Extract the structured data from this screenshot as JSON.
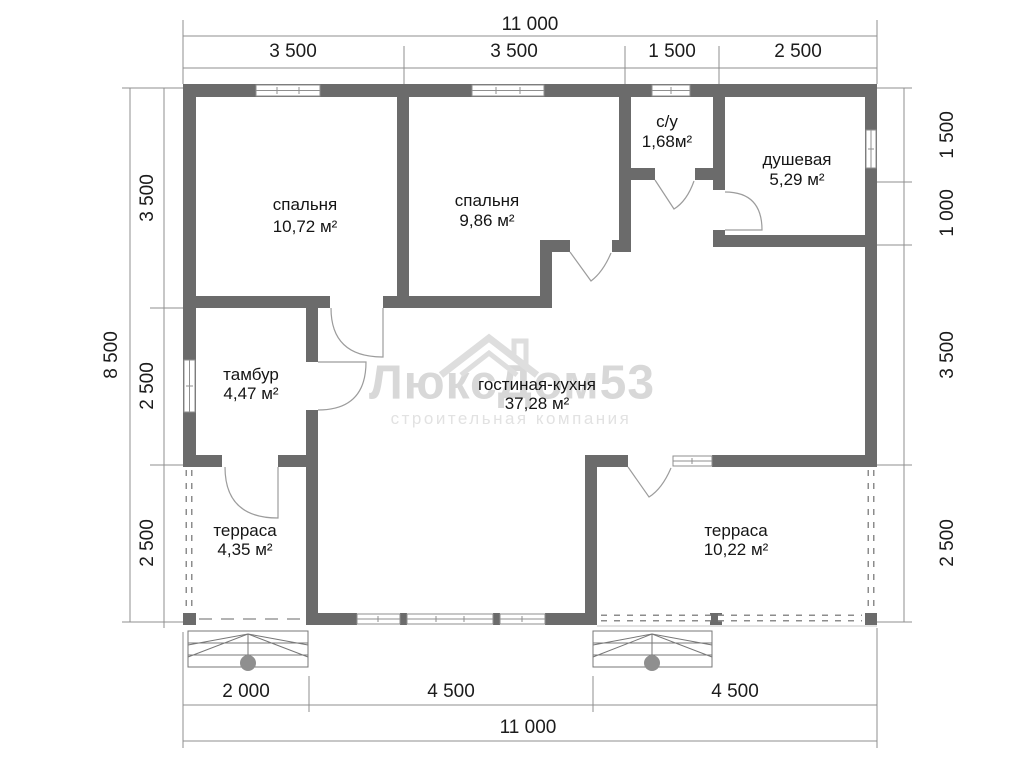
{
  "dimensions": {
    "top": {
      "overall": "11 000",
      "segments": [
        "3 500",
        "3 500",
        "1 500",
        "2 500"
      ]
    },
    "bottom": {
      "overall": "11 000",
      "segments": [
        "2 000",
        "4 500",
        "4 500"
      ]
    },
    "left": {
      "overall": "8 500",
      "segments": [
        "3 500",
        "2 500",
        "2 500"
      ]
    },
    "right": {
      "segments": [
        "1 500",
        "1 000",
        "3 500",
        "2 500"
      ]
    }
  },
  "rooms": {
    "bedroom1": {
      "name": "спальня",
      "area": "10,72 м²"
    },
    "bedroom2": {
      "name": "спальня",
      "area": "9,86 м²"
    },
    "wc": {
      "name": "с/у",
      "area": "1,68м²"
    },
    "shower": {
      "name": "душевая",
      "area": "5,29 м²"
    },
    "tambour": {
      "name": "тамбур",
      "area": "4,47 м²"
    },
    "living": {
      "name": "гостиная-кухня",
      "area": "37,28 м²"
    },
    "terrace_left": {
      "name": "терраса",
      "area": "4,35 м²"
    },
    "terrace_right": {
      "name": "терраса",
      "area": "10,22 м²"
    }
  },
  "watermark": {
    "title": "ЛюксДом53",
    "subtitle": "строительная компания"
  },
  "colors": {
    "wall": "#6b6b6b",
    "dim_line": "#8f8f8f",
    "door": "#9c9c9c",
    "text": "#1c1c1c",
    "watermark": "#d8d8d8"
  }
}
